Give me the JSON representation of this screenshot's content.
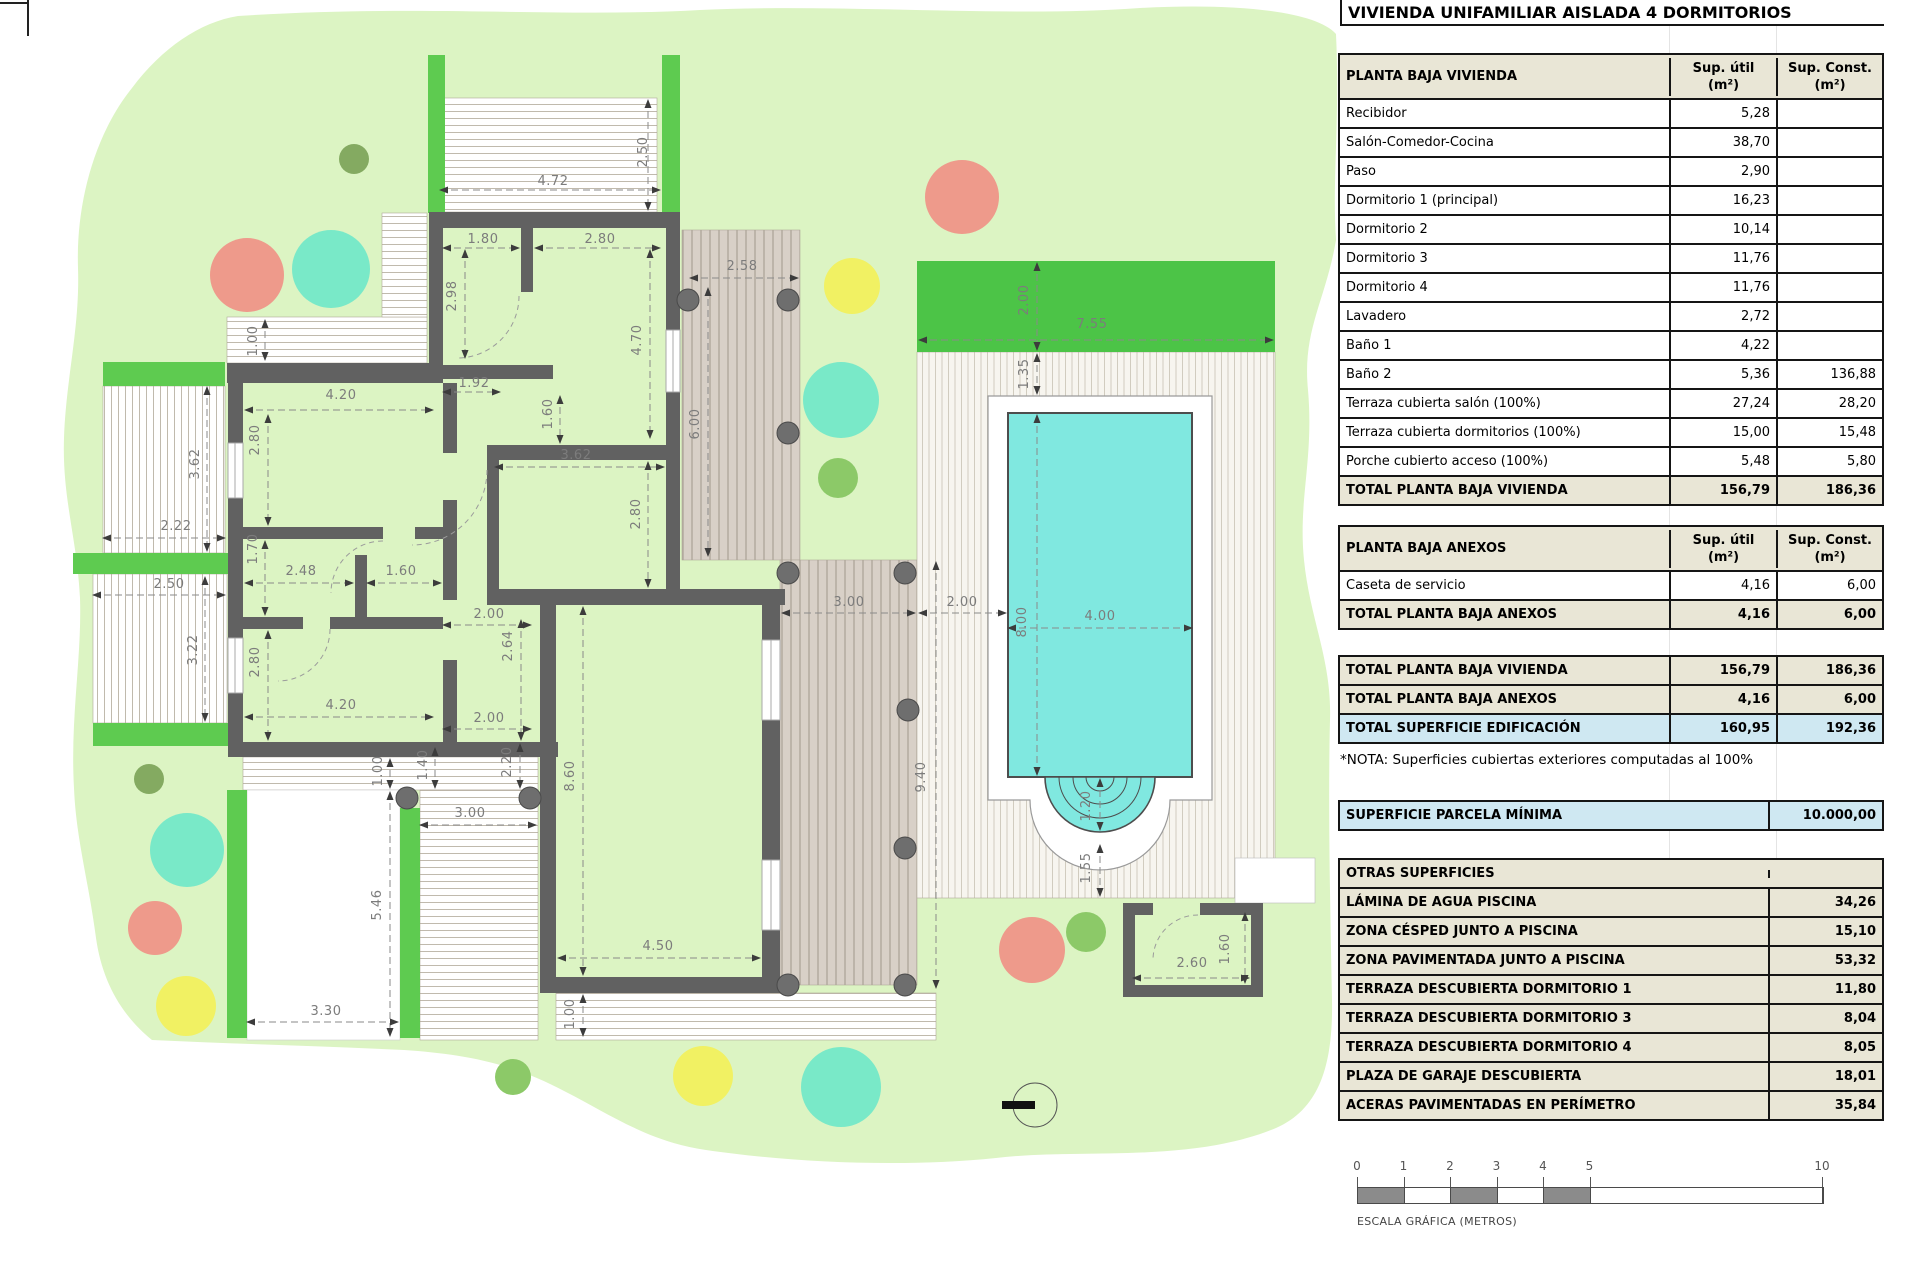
{
  "title": "VIVIENDA UNIFAMILIAR AISLADA 4 DORMITORIOS",
  "cols": {
    "util": "Sup. útil",
    "konst": "Sup. Const.",
    "unit": "(m²)"
  },
  "t1": {
    "title": "PLANTA BAJA VIVIENDA",
    "rows": [
      {
        "l": "Recibidor",
        "u": "5,28",
        "c": ""
      },
      {
        "l": "Salón-Comedor-Cocina",
        "u": "38,70",
        "c": ""
      },
      {
        "l": "Paso",
        "u": "2,90",
        "c": ""
      },
      {
        "l": "Dormitorio 1 (principal)",
        "u": "16,23",
        "c": ""
      },
      {
        "l": "Dormitorio 2",
        "u": "10,14",
        "c": ""
      },
      {
        "l": "Dormitorio 3",
        "u": "11,76",
        "c": ""
      },
      {
        "l": "Dormitorio 4",
        "u": "11,76",
        "c": ""
      },
      {
        "l": "Lavadero",
        "u": "2,72",
        "c": ""
      },
      {
        "l": "Baño 1",
        "u": "4,22",
        "c": ""
      },
      {
        "l": "Baño 2",
        "u": "5,36",
        "c": "136,88"
      },
      {
        "l": "Terraza cubierta salón (100%)",
        "u": "27,24",
        "c": "28,20"
      },
      {
        "l": "Terraza cubierta dormitorios (100%)",
        "u": "15,00",
        "c": "15,48"
      },
      {
        "l": "Porche cubierto acceso (100%)",
        "u": "5,48",
        "c": "5,80"
      }
    ],
    "total": {
      "l": "TOTAL PLANTA BAJA VIVIENDA",
      "u": "156,79",
      "c": "186,36"
    }
  },
  "t2": {
    "title": "PLANTA BAJA ANEXOS",
    "rows": [
      {
        "l": "Caseta de servicio",
        "u": "4,16",
        "c": "6,00"
      }
    ],
    "total": {
      "l": "TOTAL PLANTA BAJA ANEXOS",
      "u": "4,16",
      "c": "6,00"
    }
  },
  "summary": {
    "rows": [
      {
        "l": "TOTAL PLANTA BAJA VIVIENDA",
        "u": "156,79",
        "c": "186,36",
        "hl": false
      },
      {
        "l": "TOTAL PLANTA BAJA ANEXOS",
        "u": "4,16",
        "c": "6,00",
        "hl": false
      },
      {
        "l": "TOTAL SUPERFICIE EDIFICACIÓN",
        "u": "160,95",
        "c": "192,36",
        "hl": true
      }
    ]
  },
  "nota": "*NOTA: Superficies cubiertas exteriores computadas al 100%",
  "parcela": {
    "l": "SUPERFICIE PARCELA MÍNIMA",
    "v": "10.000,00"
  },
  "otras": {
    "title": "OTRAS SUPERFICIES",
    "rows": [
      {
        "l": "LÁMINA DE AGUA PISCINA",
        "v": "34,26"
      },
      {
        "l": "ZONA CÉSPED JUNTO A PISCINA",
        "v": "15,10"
      },
      {
        "l": "ZONA PAVIMENTADA JUNTO A PISCINA",
        "v": "53,32"
      },
      {
        "l": "TERRAZA DESCUBIERTA DORMITORIO 1",
        "v": "11,80"
      },
      {
        "l": "TERRAZA DESCUBIERTA DORMITORIO 3",
        "v": "8,04"
      },
      {
        "l": "TERRAZA DESCUBIERTA DORMITORIO 4",
        "v": "8,05"
      },
      {
        "l": "PLAZA DE GARAJE DESCUBIERTA",
        "v": "18,01"
      },
      {
        "l": "ACERAS PAVIMENTADAS EN PERÍMETRO",
        "v": "35,84"
      }
    ]
  },
  "scalebar": {
    "caption": "ESCALA GRÁFICA (METROS)",
    "px_per_m": 46.5,
    "ticks": [
      {
        "label": "0",
        "m": 0
      },
      {
        "label": "1",
        "m": 1
      },
      {
        "label": "2",
        "m": 2
      },
      {
        "label": "3",
        "m": 3
      },
      {
        "label": "4",
        "m": 4
      },
      {
        "label": "5",
        "m": 5
      },
      {
        "label": "10",
        "m": 10
      }
    ],
    "segments": [
      {
        "from": 0,
        "to": 1,
        "filled": true
      },
      {
        "from": 1,
        "to": 2,
        "filled": false
      },
      {
        "from": 2,
        "to": 3,
        "filled": true
      },
      {
        "from": 3,
        "to": 4,
        "filled": false
      },
      {
        "from": 4,
        "to": 5,
        "filled": true
      },
      {
        "from": 5,
        "to": 10,
        "filled": false
      }
    ]
  },
  "plan": {
    "colors": {
      "parcel": "#dcf4c3",
      "hedge": "#5ecb50",
      "lawn": "#4cc447",
      "pool": "#80e8e0",
      "pool_stroke": "#4d4d4d",
      "wall": "#616161",
      "salmon": "#ee9a8b",
      "teal": "#79e9c8",
      "yellow": "#f1f163",
      "green": "#8cc968",
      "olive": "#84aa61",
      "post": "#6e6e6e"
    },
    "dimension_labels": [
      {
        "t": "4.72",
        "x": 553,
        "y": 185,
        "r": 0
      },
      {
        "t": "2.50",
        "x": 647,
        "y": 152,
        "r": 1
      },
      {
        "t": "1.80",
        "x": 483,
        "y": 243,
        "r": 0
      },
      {
        "t": "2.80",
        "x": 600,
        "y": 243,
        "r": 0
      },
      {
        "t": "2.98",
        "x": 456,
        "y": 296,
        "r": 1
      },
      {
        "t": "4.70",
        "x": 641,
        "y": 340,
        "r": 1
      },
      {
        "t": "1.92",
        "x": 474,
        "y": 387,
        "r": 0
      },
      {
        "t": "2.58",
        "x": 742,
        "y": 270,
        "r": 0
      },
      {
        "t": "6.00",
        "x": 699,
        "y": 424,
        "r": 1
      },
      {
        "t": "1.60",
        "x": 552,
        "y": 414,
        "r": 1
      },
      {
        "t": "3.62",
        "x": 576,
        "y": 459,
        "r": 0
      },
      {
        "t": "2.80",
        "x": 640,
        "y": 514,
        "r": 1
      },
      {
        "t": "1.00",
        "x": 257,
        "y": 341,
        "r": 1
      },
      {
        "t": "4.20",
        "x": 341,
        "y": 399,
        "r": 0
      },
      {
        "t": "2.80",
        "x": 259,
        "y": 440,
        "r": 1
      },
      {
        "t": "3.62",
        "x": 199,
        "y": 464,
        "r": 1
      },
      {
        "t": "2.22",
        "x": 176,
        "y": 530,
        "r": 0
      },
      {
        "t": "1.70",
        "x": 257,
        "y": 549,
        "r": 1
      },
      {
        "t": "2.48",
        "x": 301,
        "y": 575,
        "r": 0
      },
      {
        "t": "1.60",
        "x": 401,
        "y": 575,
        "r": 0
      },
      {
        "t": "2.50",
        "x": 169,
        "y": 588,
        "r": 0
      },
      {
        "t": "3.22",
        "x": 197,
        "y": 650,
        "r": 1
      },
      {
        "t": "2.80",
        "x": 259,
        "y": 662,
        "r": 1
      },
      {
        "t": "4.20",
        "x": 341,
        "y": 709,
        "r": 0
      },
      {
        "t": "2.00",
        "x": 489,
        "y": 618,
        "r": 0
      },
      {
        "t": "2.64",
        "x": 512,
        "y": 646,
        "r": 1
      },
      {
        "t": "2.00",
        "x": 489,
        "y": 722,
        "r": 0
      },
      {
        "t": "2.20",
        "x": 511,
        "y": 762,
        "r": 1
      },
      {
        "t": "1.40",
        "x": 427,
        "y": 765,
        "r": 1
      },
      {
        "t": "8.60",
        "x": 574,
        "y": 776,
        "r": 1
      },
      {
        "t": "1.00",
        "x": 382,
        "y": 771,
        "r": 1
      },
      {
        "t": "3.00",
        "x": 470,
        "y": 817,
        "r": 0
      },
      {
        "t": "5.46",
        "x": 381,
        "y": 905,
        "r": 1
      },
      {
        "t": "3.30",
        "x": 326,
        "y": 1015,
        "r": 0
      },
      {
        "t": "4.50",
        "x": 658,
        "y": 950,
        "r": 0
      },
      {
        "t": "1.00",
        "x": 574,
        "y": 1014,
        "r": 1
      },
      {
        "t": "9.40",
        "x": 925,
        "y": 777,
        "r": 1
      },
      {
        "t": "3.00",
        "x": 849,
        "y": 606,
        "r": 0
      },
      {
        "t": "2.00",
        "x": 962,
        "y": 606,
        "r": 0
      },
      {
        "t": "8.00",
        "x": 1026,
        "y": 622,
        "r": 1
      },
      {
        "t": "4.00",
        "x": 1100,
        "y": 620,
        "r": 0
      },
      {
        "t": "2.00",
        "x": 1028,
        "y": 300,
        "r": 1
      },
      {
        "t": "7.55",
        "x": 1092,
        "y": 328,
        "r": 0
      },
      {
        "t": "1.35",
        "x": 1028,
        "y": 374,
        "r": 1
      },
      {
        "t": "1.20",
        "x": 1090,
        "y": 806,
        "r": 1
      },
      {
        "t": "1.55",
        "x": 1090,
        "y": 868,
        "r": 1
      },
      {
        "t": "2.60",
        "x": 1192,
        "y": 967,
        "r": 0
      },
      {
        "t": "1.60",
        "x": 1229,
        "y": 949,
        "r": 1
      }
    ],
    "dimension_lines": [
      [
        440,
        190,
        660,
        190
      ],
      [
        648,
        100,
        648,
        210
      ],
      [
        465,
        250,
        465,
        358
      ],
      [
        443,
        248,
        519,
        248
      ],
      [
        535,
        248,
        660,
        248
      ],
      [
        650,
        250,
        650,
        438
      ],
      [
        443,
        392,
        500,
        392
      ],
      [
        265,
        320,
        265,
        360
      ],
      [
        245,
        410,
        433,
        410
      ],
      [
        268,
        415,
        268,
        525
      ],
      [
        207,
        387,
        207,
        551
      ],
      [
        103,
        538,
        225,
        538
      ],
      [
        265,
        541,
        265,
        615
      ],
      [
        245,
        583,
        353,
        583
      ],
      [
        367,
        583,
        441,
        583
      ],
      [
        93,
        595,
        225,
        595
      ],
      [
        205,
        577,
        205,
        721
      ],
      [
        268,
        631,
        268,
        740
      ],
      [
        245,
        717,
        433,
        717
      ],
      [
        560,
        396,
        560,
        443
      ],
      [
        495,
        467,
        664,
        467
      ],
      [
        648,
        462,
        648,
        587
      ],
      [
        690,
        278,
        798,
        278
      ],
      [
        708,
        288,
        708,
        556
      ],
      [
        443,
        625,
        531,
        625
      ],
      [
        521,
        620,
        521,
        740
      ],
      [
        443,
        729,
        531,
        729
      ],
      [
        520,
        744,
        520,
        788
      ],
      [
        435,
        748,
        435,
        788
      ],
      [
        583,
        607,
        583,
        975
      ],
      [
        390,
        759,
        390,
        788
      ],
      [
        420,
        825,
        536,
        825
      ],
      [
        390,
        792,
        390,
        1036
      ],
      [
        247,
        1022,
        398,
        1022
      ],
      [
        558,
        958,
        760,
        958
      ],
      [
        583,
        995,
        583,
        1036
      ],
      [
        936,
        562,
        936,
        988
      ],
      [
        782,
        613,
        915,
        613
      ],
      [
        919,
        613,
        1006,
        613
      ],
      [
        1037,
        415,
        1037,
        775
      ],
      [
        1008,
        628,
        1192,
        628
      ],
      [
        1037,
        263,
        1037,
        350
      ],
      [
        919,
        340,
        1273,
        340
      ],
      [
        1037,
        354,
        1037,
        394
      ],
      [
        1100,
        779,
        1100,
        830
      ],
      [
        1100,
        845,
        1100,
        896
      ],
      [
        1133,
        978,
        1249,
        978
      ],
      [
        1245,
        913,
        1245,
        983
      ]
    ],
    "trees": [
      {
        "x": 354,
        "y": 159,
        "r": 15,
        "c": "olive"
      },
      {
        "x": 247,
        "y": 275,
        "r": 37,
        "c": "salmon"
      },
      {
        "x": 331,
        "y": 269,
        "r": 39,
        "c": "teal"
      },
      {
        "x": 962,
        "y": 197,
        "r": 37,
        "c": "salmon"
      },
      {
        "x": 852,
        "y": 286,
        "r": 28,
        "c": "yellow"
      },
      {
        "x": 841,
        "y": 400,
        "r": 38,
        "c": "teal"
      },
      {
        "x": 838,
        "y": 478,
        "r": 20,
        "c": "green"
      },
      {
        "x": 149,
        "y": 779,
        "r": 15,
        "c": "olive"
      },
      {
        "x": 187,
        "y": 850,
        "r": 37,
        "c": "teal"
      },
      {
        "x": 155,
        "y": 928,
        "r": 27,
        "c": "salmon"
      },
      {
        "x": 186,
        "y": 1006,
        "r": 30,
        "c": "yellow"
      },
      {
        "x": 513,
        "y": 1077,
        "r": 18,
        "c": "green"
      },
      {
        "x": 703,
        "y": 1076,
        "r": 30,
        "c": "yellow"
      },
      {
        "x": 841,
        "y": 1087,
        "r": 40,
        "c": "teal"
      },
      {
        "x": 1032,
        "y": 950,
        "r": 33,
        "c": "salmon"
      },
      {
        "x": 1086,
        "y": 932,
        "r": 20,
        "c": "green"
      }
    ],
    "posts": [
      [
        688,
        300
      ],
      [
        788,
        300
      ],
      [
        788,
        433
      ],
      [
        788,
        573
      ],
      [
        905,
        573
      ],
      [
        908,
        710
      ],
      [
        905,
        848
      ],
      [
        788,
        985
      ],
      [
        905,
        985
      ],
      [
        407,
        798
      ],
      [
        530,
        798
      ]
    ],
    "hedges": [
      [
        428,
        55,
        17,
        158
      ],
      [
        662,
        55,
        18,
        158
      ],
      [
        103,
        362,
        122,
        24
      ],
      [
        73,
        553,
        155,
        21
      ],
      [
        93,
        723,
        135,
        23
      ],
      [
        227,
        790,
        20,
        248
      ],
      [
        400,
        808,
        20,
        230
      ]
    ]
  }
}
